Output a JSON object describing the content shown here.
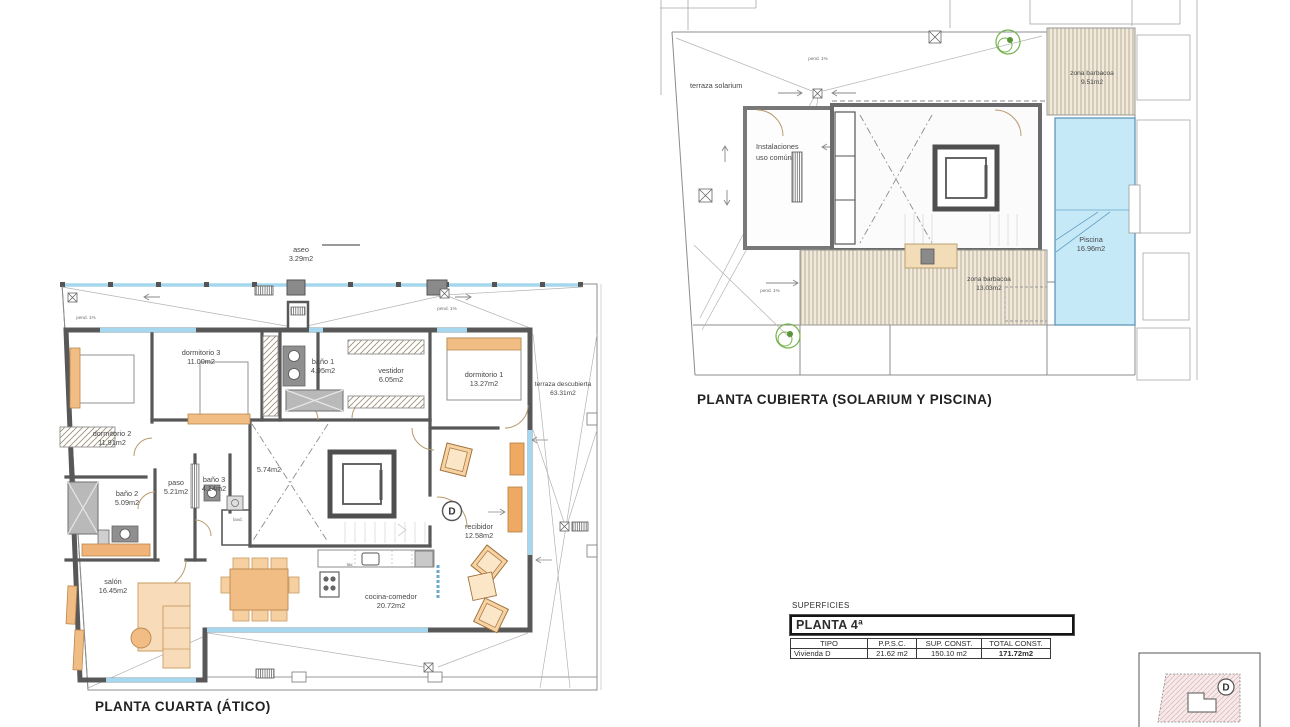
{
  "colors": {
    "wall": "#585858",
    "glazing": "#a5d8ee",
    "pool": "#c6e9f8",
    "furniture": "#f2bd85",
    "furniture_light": "#f8dcb9",
    "deck_hatch": "#efe8da",
    "plant_green": "#76b34c"
  },
  "floor4": {
    "title": "PLANTA CUARTA (ÁTICO)",
    "unit_marker": "D",
    "labels": {
      "aseo": {
        "l1": "aseo",
        "l2": "3.29m2"
      },
      "dorm3": {
        "l1": "dormitorio 3",
        "l2": "11.00m2"
      },
      "bano1": {
        "l1": "baño 1",
        "l2": "4.95m2"
      },
      "vestidor": {
        "l1": "vestidor",
        "l2": "6.05m2"
      },
      "dorm1": {
        "l1": "dormitorio 1",
        "l2": "13.27m2"
      },
      "terraza": {
        "l1": "terraza descubierta",
        "l2": "63.31m2"
      },
      "dorm2": {
        "l1": "dormitorio 2",
        "l2": "11.91m2"
      },
      "paso": {
        "l1": "paso",
        "l2": "5.21m2"
      },
      "bano3": {
        "l1": "baño 3",
        "l2": "4.14m2"
      },
      "hueco": {
        "l1": "5.74m2"
      },
      "bano2": {
        "l1": "baño 2",
        "l2": "5.09m2"
      },
      "recibidor": {
        "l1": "recibidor",
        "l2": "12.58m2"
      },
      "salon": {
        "l1": "salón",
        "l2": "16.45m2"
      },
      "cocina": {
        "l1": "cocina-comedor",
        "l2": "20.72m2"
      },
      "lavd": "lavd.",
      "lav": "lav.",
      "pend": "pend. 1%"
    }
  },
  "roof": {
    "title": "PLANTA CUBIERTA (SOLARIUM Y PISCINA)",
    "labels": {
      "solarium": {
        "l1": "terraza solarium"
      },
      "instalaciones": {
        "l1": "Instalaciones",
        "l2": "uso común"
      },
      "barbacoa1": {
        "l1": "zona barbacoa",
        "l2": "9.51m2"
      },
      "piscina": {
        "l1": "Piscina",
        "l2": "16.96m2"
      },
      "barbacoa2": {
        "l1": "zona barbacoa",
        "l2": "13.03m2"
      },
      "pend": "pend. 1%"
    }
  },
  "surfaces": {
    "section_label": "SUPERFICIES",
    "plan_label": "PLANTA 4ª",
    "columns": [
      "TIPO",
      "P.P.S.C.",
      "SUP. CONST.",
      "TOTAL CONST."
    ],
    "row": {
      "tipo": "Vivienda D",
      "ppsc": "21.62 m2",
      "sup": "150.10 m2",
      "total": "171.72m2"
    }
  },
  "key_plan": {
    "marker": "D"
  }
}
